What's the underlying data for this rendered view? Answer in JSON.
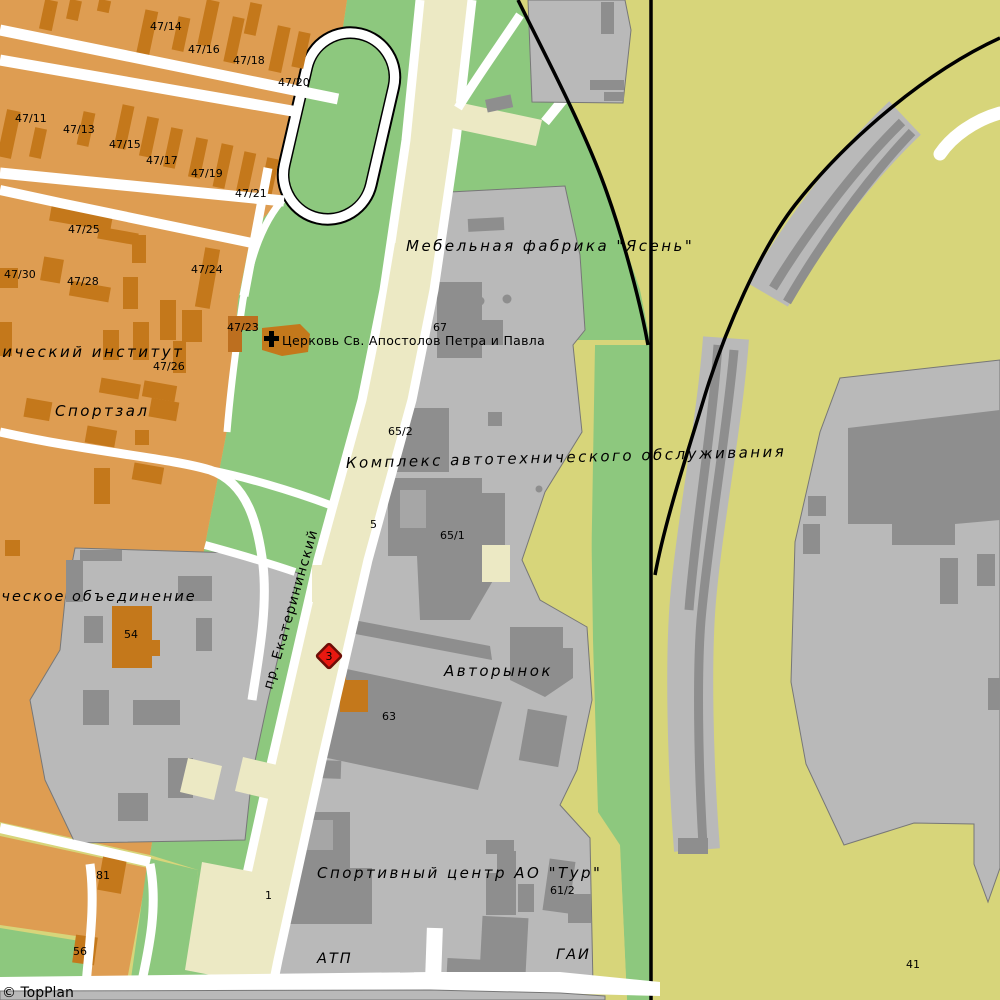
{
  "map": {
    "attribution": "© TopPlan",
    "street": {
      "name": "пр. Екатерининский"
    },
    "places": {
      "furniture_factory": "Мебельная фабрика \"Ясень\"",
      "church": "Церковь Св. Апостолов Петра и Павла",
      "auto_service": "Комплекс автотехнического обслуживания",
      "car_market": "Авторынок",
      "sport_center": "Спортивный центр АО \"Тур\"",
      "atp": "АТП",
      "gai": "ГАИ",
      "sport_hall": "Спортзал",
      "institute": "нический институт",
      "association": "ическое объединение"
    },
    "houses": {
      "h47_11": "47/11",
      "h47_13": "47/13",
      "h47_14": "47/14",
      "h47_15": "47/15",
      "h47_16": "47/16",
      "h47_17": "47/17",
      "h47_18": "47/18",
      "h47_19": "47/19",
      "h47_20": "47/20",
      "h47_21": "47/21",
      "h47_23": "47/23",
      "h47_24": "47/24",
      "h47_25": "47/25",
      "h47_26": "47/26",
      "h47_28": "47/28",
      "h47_30": "47/30",
      "n1": "1",
      "n5": "5",
      "n41": "41",
      "n54": "54",
      "n56": "56",
      "n61_2": "61/2",
      "n63": "63",
      "n65_1": "65/1",
      "n65_2": "65/2",
      "n67": "67",
      "n81": "81"
    },
    "marker": {
      "value": "3",
      "color": "#e81810"
    },
    "colors": {
      "residential": "#de9d52",
      "residential_building": "#c4781b",
      "park": "#8dc87e",
      "field": "#d7d57a",
      "industrial": "#b9b9b9",
      "industrial_building": "#8e8e8e",
      "avenue": "#ece9c4",
      "road": "#ffffff",
      "railway": "#000000",
      "marker": "#e81810"
    }
  }
}
